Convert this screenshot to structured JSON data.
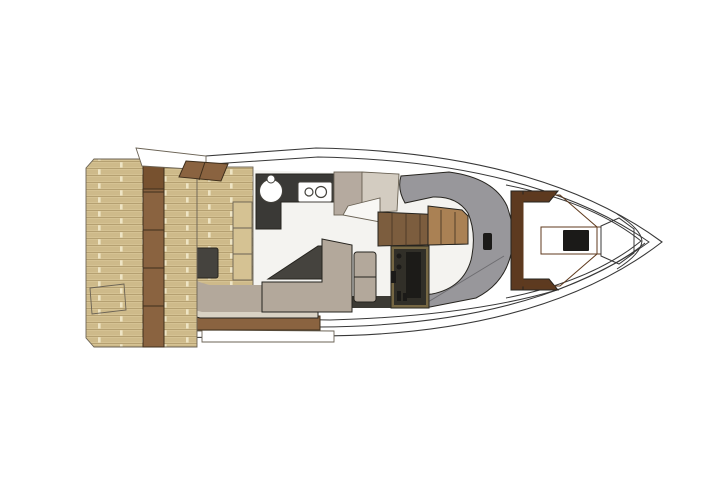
{
  "meta": {
    "title": "Motor yacht main deck floor plan",
    "view": "top-down",
    "orientation": "bow-right",
    "background": "#ffffff"
  },
  "colors": {
    "hull_white": "#ffffff",
    "outline": "#383838",
    "teak_base": "#d5c293",
    "teak_joint": "#eee4c4",
    "wood_trim": "#8a6340",
    "wood_trim_dark": "#77512f",
    "olive_back": "#6f5d3d",
    "sofa_border": "#d9d2c4",
    "sofa_seat": "#b3a89b",
    "table_dark": "#45433e",
    "counter_dark": "#3a3936",
    "cabinet": "#b5aa9f",
    "cabinet_light": "#d3ccc1",
    "console_white": "#f8f7f4",
    "floor": "#f4f3f0",
    "stairs_dark": "#7c5d3e",
    "stairs_light": "#aa8154",
    "door_frame": "#766743",
    "door_dark": "#312f28",
    "door_screen": "#1c1b18",
    "dash_gray": "#98979b",
    "strip_dark": "#3c3a34",
    "orange": "#c2692c",
    "bow_frame": "#5d3a20",
    "bow_table": "#1b1a18",
    "appliance_white": "#ffffff",
    "step_white": "#ffffff"
  },
  "parts": {
    "hull": "hull outline",
    "swim_platform": "teak swim platform",
    "platform_hatch": "platform hatch",
    "transom_trim": "transom wood trim",
    "side_deck_step": "side deck step",
    "cockpit_step": "cockpit wood step",
    "cockpit_floor": "cockpit teak floor",
    "cockpit_sofa": "L-shaped cockpit sofa",
    "cockpit_table": "cockpit table",
    "cockpit_bench": "cockpit side bench",
    "stern_step": "stern step",
    "galley_counter": "galley counter",
    "sink": "sink",
    "cooktop": "two-burner cooktop",
    "galley_cabinet": "galley cabinet",
    "nav_console": "console",
    "stairs": "companionway stairs",
    "companionway_door": "companionway door",
    "helm_dash": "helm / windshield dash",
    "dash_vent": "dash vent",
    "salon_sofa": "salon sofa",
    "salon_table": "salon table",
    "ottoman": "ottoman seat",
    "bow_seating": "bow lounge seating",
    "bow_backrest": "bow seat backrest",
    "bow_table": "bow table",
    "anchor_hatch": "anchor locker hatch"
  }
}
